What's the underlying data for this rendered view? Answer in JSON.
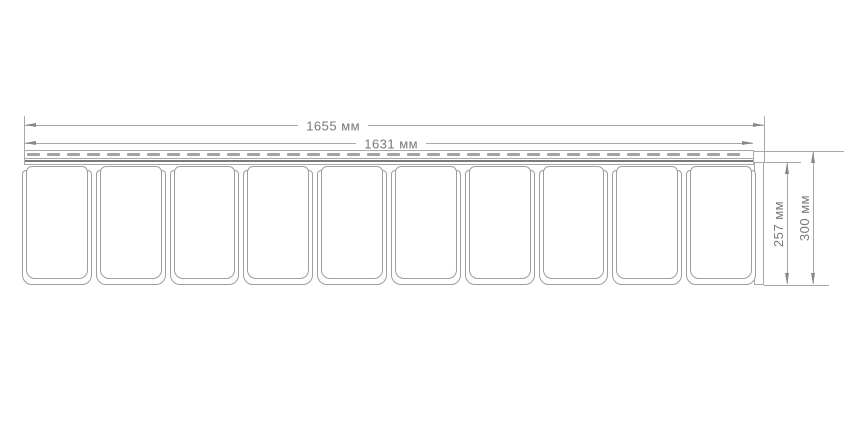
{
  "drawing": {
    "description": "siding-panel-dimension-drawing",
    "unit": "мм",
    "dimensions": {
      "total_width_label": "1655 мм",
      "total_width_value": 1655,
      "visible_width_label": "1631 мм",
      "visible_width_value": 1631,
      "panel_height_label": "257 мм",
      "panel_height_value": 257,
      "total_height_label": "300 мм",
      "total_height_value": 300
    },
    "panels": {
      "count": 10
    },
    "nail_hem": {
      "slot_count": 36
    },
    "colors": {
      "line": "#a8a8a8",
      "panel_border": "#9e9e9e",
      "dark_line": "#7c7c7c",
      "slot_fill": "#a4a4a4",
      "arrow": "#878787",
      "text": "#787878",
      "background": "#ffffff"
    }
  }
}
